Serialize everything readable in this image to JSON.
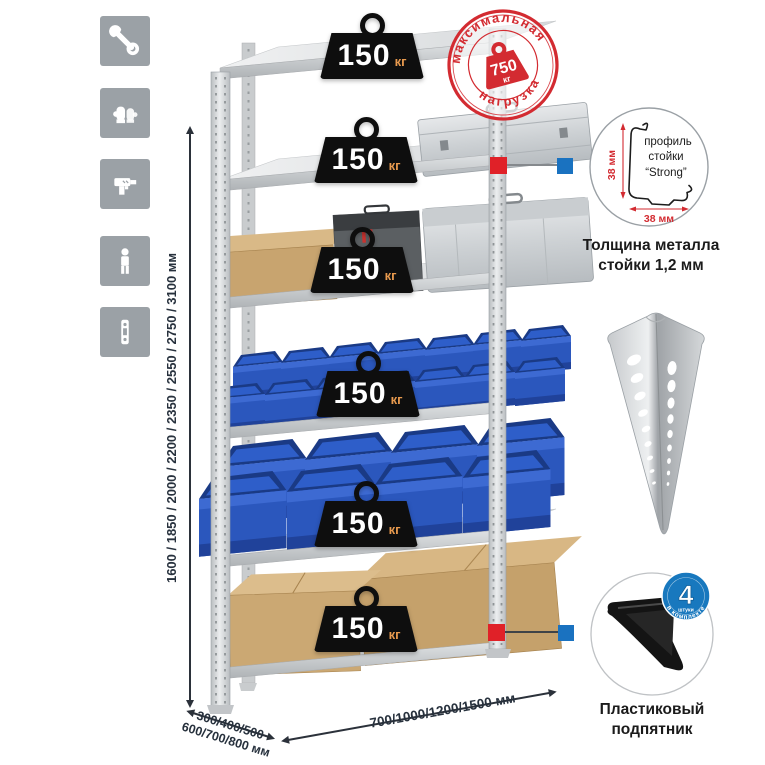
{
  "icons": {
    "left_column": [
      "wrench-icon",
      "gloves-icon",
      "drill-icon",
      "person-icon",
      "rack-post-icon"
    ]
  },
  "colors": {
    "icon_bg": "#9ba1a6",
    "stamp_red": "#d32b31",
    "marker_red": "#e02128",
    "marker_blue": "#1a72c0",
    "bin_blue": "#2b57bd",
    "cardboard": "#c8a46f",
    "metal_light": "#e6e8ea",
    "badge_black": "#0e0e0e",
    "badge_unit_orange": "#e89a4e",
    "dimension_text": "#27313d"
  },
  "stamp": {
    "arc_top": "максимальная",
    "arc_bottom": "нагрузка",
    "weight_value": "750",
    "weight_unit": "кг"
  },
  "shelf_loads": [
    {
      "value": "150",
      "unit": "кг"
    },
    {
      "value": "150",
      "unit": "кг"
    },
    {
      "value": "150",
      "unit": "кг"
    },
    {
      "value": "150",
      "unit": "кг"
    },
    {
      "value": "150",
      "unit": "кг"
    },
    {
      "value": "150",
      "unit": "кг"
    }
  ],
  "height_options": {
    "label": "1600 / 1850 / 2000 / 2200 / 2350 / 2550 / 2750 / 3100 мм"
  },
  "depth_options": {
    "line1": "300/400/500",
    "line2": "600/700/800 мм"
  },
  "width_options": {
    "label": "700/1000/1200/1500 мм"
  },
  "profile_detail": {
    "text_line1": "профиль",
    "text_line2": "стойки",
    "text_line3": "“Strong”",
    "dim_vertical": "38 мм",
    "dim_horizontal": "38 мм",
    "caption_line1": "Толщина металла",
    "caption_line2": "стойки 1,2 мм"
  },
  "foot_detail": {
    "badge_count": "4",
    "badge_word": "штуки",
    "badge_arc": "в комплекте",
    "caption_line1": "Пластиковый",
    "caption_line2": "подпятник"
  }
}
